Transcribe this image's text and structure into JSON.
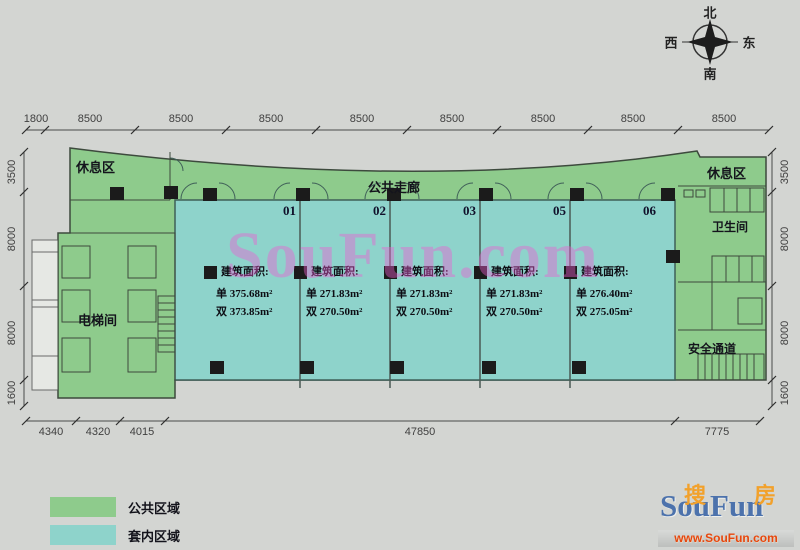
{
  "compass": {
    "north": "北",
    "south": "南",
    "west": "西",
    "east": "东"
  },
  "dimensions": {
    "top": [
      "1800",
      "8500",
      "8500",
      "8500",
      "8500",
      "8500",
      "8500",
      "8500",
      "8500"
    ],
    "left": [
      "3500",
      "8000",
      "8000",
      "1600"
    ],
    "right": [
      "3500",
      "8000",
      "8000",
      "1600"
    ],
    "bottom": [
      "4340",
      "4320",
      "4015",
      "47850",
      "7775"
    ]
  },
  "plan": {
    "corridor_label": "公共走廊",
    "rest_area_left": "休息区",
    "rest_area_right": "休息区",
    "elevator_label": "电梯间",
    "restroom_label": "卫生间",
    "safety_exit_label": "安全通道",
    "units": [
      {
        "number": "01",
        "area_title": "建筑面积:",
        "single": "单 375.68m²",
        "double": "双 373.85m²"
      },
      {
        "number": "02",
        "area_title": "建筑面积:",
        "single": "单 271.83m²",
        "double": "双 270.50m²"
      },
      {
        "number": "03",
        "area_title": "建筑面积:",
        "single": "单 271.83m²",
        "double": "双 270.50m²"
      },
      {
        "number": "05",
        "area_title": "建筑面积:",
        "single": "单 271.83m²",
        "double": "双 270.50m²"
      },
      {
        "number": "06",
        "area_title": "建筑面积:",
        "single": "单 276.40m²",
        "double": "双 275.05m²"
      }
    ]
  },
  "legend": {
    "public": {
      "label": "公共区域",
      "color": "#8ecb8c"
    },
    "interior": {
      "label": "套内区域",
      "color": "#8ed3cb"
    }
  },
  "watermark": "SouFun.com",
  "logo": {
    "sou": "搜",
    "fang": "房",
    "brand": "SouFun",
    "url": "www.SouFun.com"
  },
  "colors": {
    "background": "#d3d5d2",
    "public_area": "#8ecb8c",
    "interior_area": "#8ed3cb",
    "column": "#1b1b1b",
    "watermark_pink": "#ee5cd2",
    "logo_blue": "#4c72ac",
    "logo_orange": "#f2a12b",
    "logo_red": "#e5470f"
  }
}
